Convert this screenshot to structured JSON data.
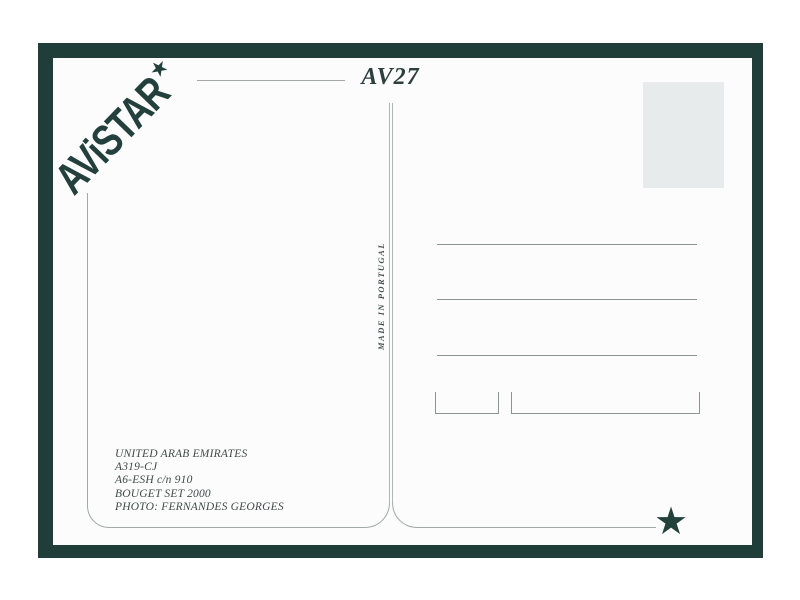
{
  "postcard": {
    "colors": {
      "border_green": "#1f3e3a",
      "card_background": "#fcfcfc",
      "stamp_box": "#e7ebeb",
      "rule_gray": "#a3a9a9",
      "ink": "#2c403d"
    },
    "publisher": {
      "logo_text": "AViSTAR",
      "logo_star": "★"
    },
    "card_number": "AV27",
    "divider": {
      "made_in_text": "MADE IN PORTUGAL"
    },
    "address_panel": {
      "address_lines_count": 3,
      "code_boxes_count": 2
    },
    "caption": {
      "lines": [
        "UNITED ARAB EMIRATES",
        "A319-CJ",
        "A6-ESH c/n 910",
        "BOUGET SET 2000",
        "PHOTO: FERNANDES GEORGES"
      ]
    },
    "corner_star": "★"
  }
}
